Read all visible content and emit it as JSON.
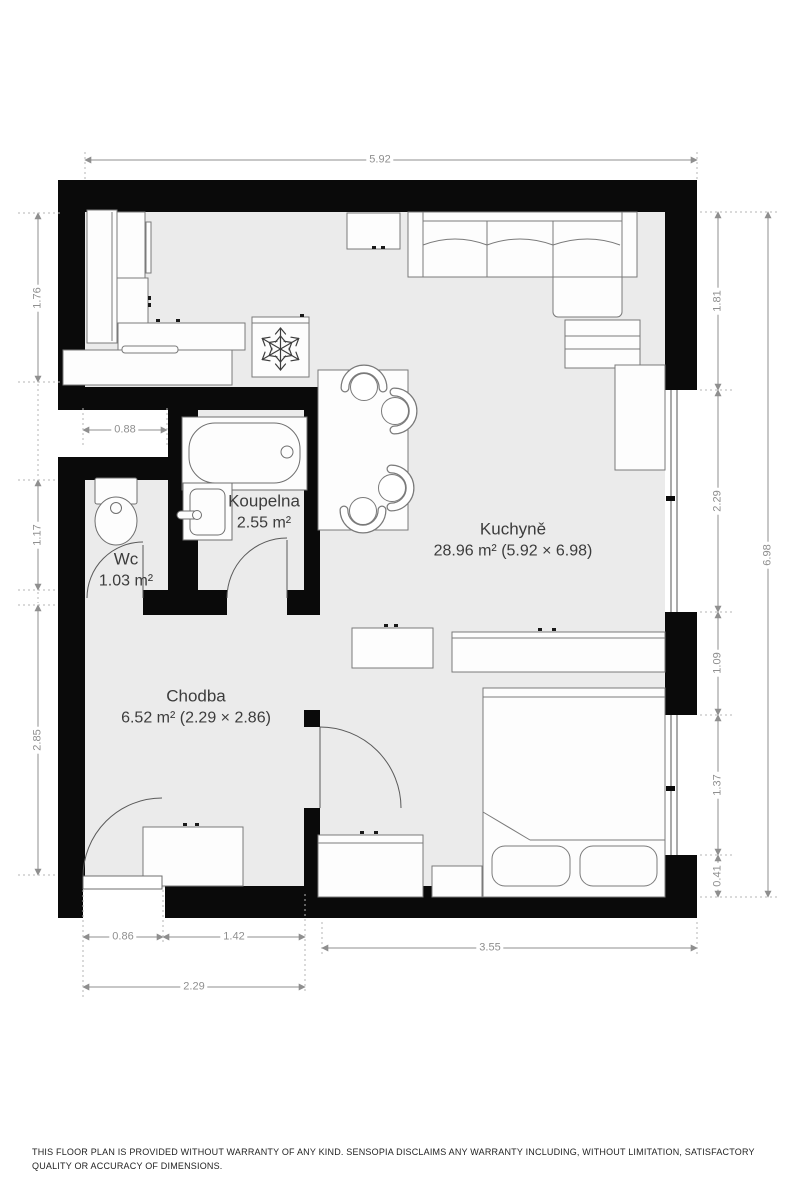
{
  "plan": {
    "rooms": [
      {
        "id": "kuchyne",
        "name": "Kuchyně",
        "area": "28.96 m² (5.92 × 6.98)"
      },
      {
        "id": "chodba",
        "name": "Chodba",
        "area": "6.52 m² (2.29 × 2.86)"
      },
      {
        "id": "koupelna",
        "name": "Koupelna",
        "area": "2.55 m²"
      },
      {
        "id": "wc",
        "name": "Wc",
        "area": "1.03 m²"
      }
    ],
    "dimensions": {
      "top_width": "5.92",
      "left": [
        "1.76",
        "1.17",
        "2.85"
      ],
      "wc_width": "0.88",
      "right": [
        "1.81",
        "2.29",
        "1.09",
        "1.37",
        "0.41"
      ],
      "right_total": "6.98",
      "bottom_left": [
        "0.86",
        "1.42"
      ],
      "bottom_left_total": "2.29",
      "bottom_right": "3.55"
    },
    "icons": [
      "snowflake-icon"
    ],
    "furniture": [
      "kitchen-counter",
      "tall-cabinet",
      "wall-cabinet",
      "freezer",
      "dining-table",
      "chair",
      "sofa",
      "chaise",
      "drawer-side-table",
      "wardrobe",
      "window",
      "bathtub",
      "sink-vanity",
      "toilet",
      "sideboard",
      "low-cabinet",
      "washing-machine",
      "bed",
      "pillow",
      "shoe-cabinet",
      "door"
    ]
  },
  "footer": {
    "disclaimer": "THIS FLOOR PLAN IS PROVIDED WITHOUT WARRANTY OF ANY KIND. SENSOPIA DISCLAIMS ANY WARRANTY INCLUDING, WITHOUT LIMITATION, SATISFACTORY QUALITY OR ACCURACY OF DIMENSIONS."
  },
  "colors": {
    "wall": "#0a0a0a",
    "floor": "#ebebeb",
    "furniture_stroke": "#7a7a7a",
    "fixture_stroke": "#6f6f6f",
    "dimension": "#8f8f8f",
    "label": "#3c3c3c",
    "background": "#ffffff"
  }
}
